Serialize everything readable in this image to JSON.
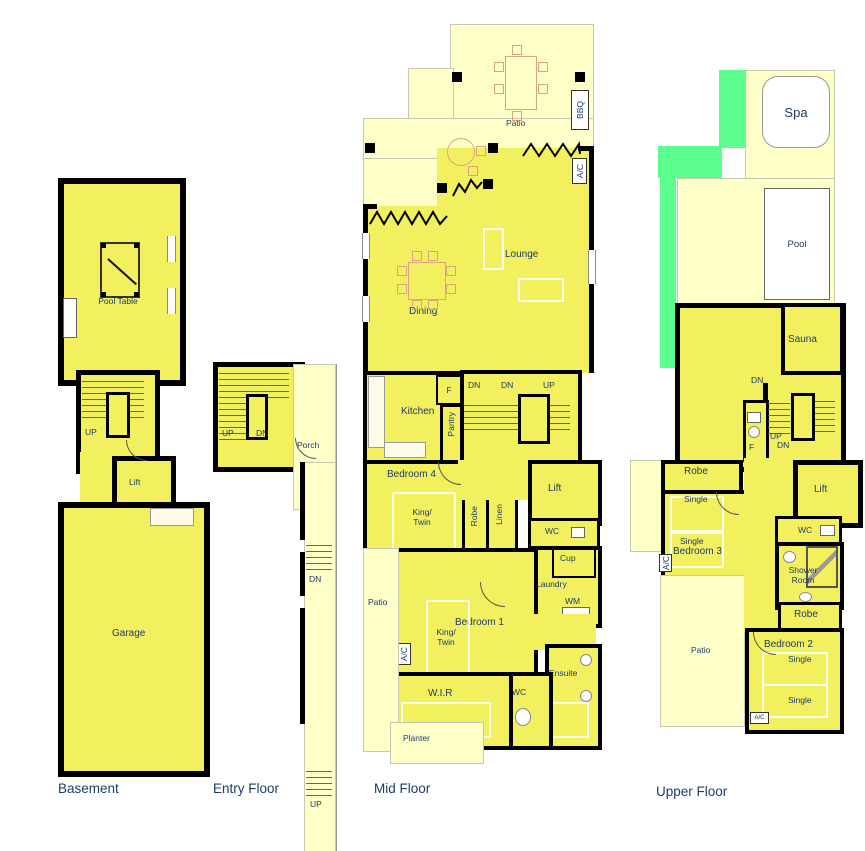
{
  "floor_titles": {
    "basement": "Basement",
    "entry": "Entry Floor",
    "mid": "Mid Floor",
    "upper": "Upper Floor"
  },
  "labels": {
    "pool_table": "Pool Table",
    "up": "UP",
    "dn": "DN",
    "lift": "Lift",
    "garage": "Garage",
    "porch": "Porch",
    "patio": "Patio",
    "bbq": "BBQ",
    "ac": "A/C",
    "lounge": "Lounge",
    "dining": "Dining",
    "kitchen": "Kitchen",
    "fridge": "F",
    "pantry": "Pantry",
    "bedroom4": "Bedroom 4",
    "king_twin": "King/ Twin",
    "robe": "Robe",
    "linen": "Linen",
    "wc": "WC",
    "cup": "Cup",
    "laundry": "Laundry",
    "wm": "WM",
    "bedroom1": "Bedroom 1",
    "ensuite": "Ensuite",
    "wir": "W.I.R",
    "planter": "Planter",
    "spa": "Spa",
    "pool": "Pool",
    "sauna": "Sauna",
    "bedroom3": "Bedroom 3",
    "single": "Single",
    "shower_room": "Shower Room",
    "bedroom2": "Bedroom 2"
  },
  "colors": {
    "room_fill": "#F3F05F",
    "outdoor_fill": "#FFFFC8",
    "lawn": "#5BFD8D",
    "wall": "#000000",
    "label_text": "#1B3C6B"
  }
}
